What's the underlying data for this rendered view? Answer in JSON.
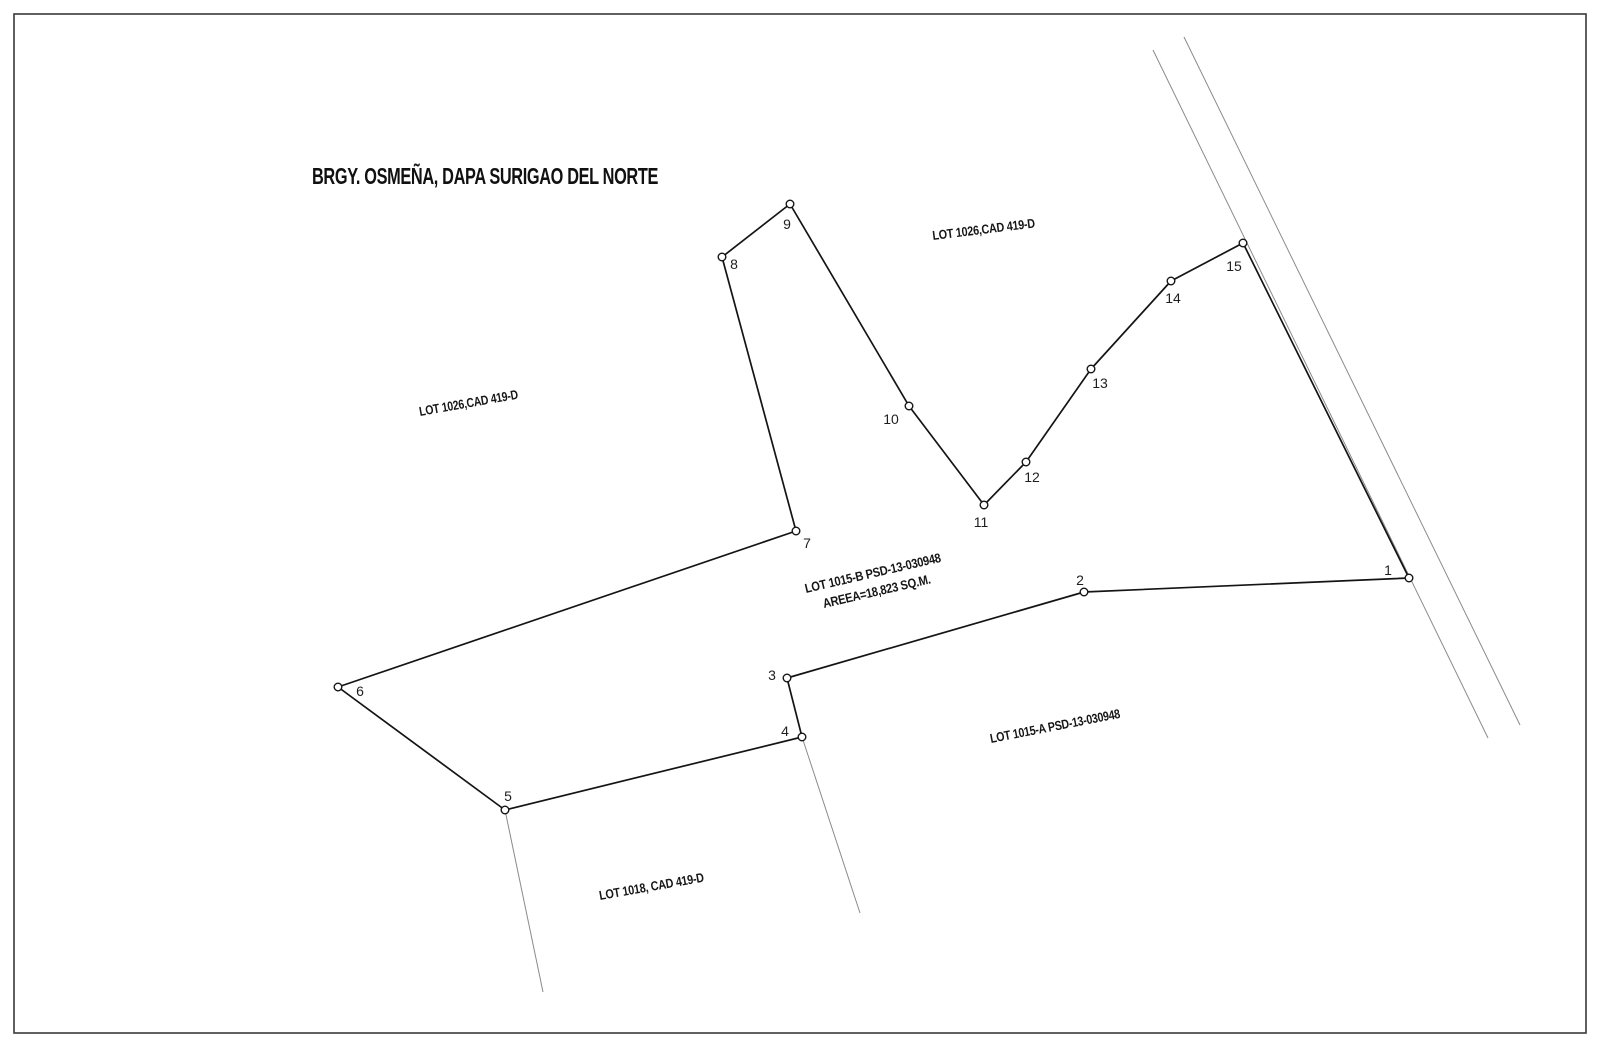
{
  "title": {
    "text": "BRGY. OSMEÑA, DAPA SURIGAO DEL NORTE"
  },
  "diagram": {
    "canvas": {
      "width": 1600,
      "height": 1047
    },
    "border": {
      "x": 14,
      "y": 14,
      "width": 1572,
      "height": 1019
    },
    "colors": {
      "background": "#ffffff",
      "boundary": "#141414",
      "thin_lines": "#8b8b8b",
      "text": "#161616"
    },
    "road_lines": [
      {
        "x1": 1153,
        "y1": 50,
        "x2": 1488,
        "y2": 738
      },
      {
        "x1": 1184,
        "y1": 37,
        "x2": 1520,
        "y2": 725
      }
    ],
    "tie_lines": [
      {
        "x1": 505,
        "y1": 810,
        "x2": 543,
        "y2": 992
      },
      {
        "x1": 802,
        "y1": 737,
        "x2": 860,
        "y2": 913
      }
    ],
    "boundary_order": [
      "1",
      "2",
      "3",
      "4",
      "5",
      "6",
      "7",
      "8",
      "9",
      "10",
      "11",
      "12",
      "13",
      "14",
      "15"
    ],
    "vertices": [
      {
        "n": "1",
        "x": 1409,
        "y": 578,
        "lx": 1388,
        "ly": 570
      },
      {
        "n": "2",
        "x": 1084,
        "y": 592,
        "lx": 1080,
        "ly": 580
      },
      {
        "n": "3",
        "x": 787,
        "y": 678,
        "lx": 772,
        "ly": 675
      },
      {
        "n": "4",
        "x": 802,
        "y": 737,
        "lx": 785,
        "ly": 731
      },
      {
        "n": "5",
        "x": 505,
        "y": 810,
        "lx": 508,
        "ly": 796
      },
      {
        "n": "6",
        "x": 338,
        "y": 687,
        "lx": 360,
        "ly": 691
      },
      {
        "n": "7",
        "x": 796,
        "y": 531,
        "lx": 807,
        "ly": 543
      },
      {
        "n": "8",
        "x": 722,
        "y": 257,
        "lx": 734,
        "ly": 264
      },
      {
        "n": "9",
        "x": 790,
        "y": 204,
        "lx": 787,
        "ly": 224
      },
      {
        "n": "10",
        "x": 909,
        "y": 406,
        "lx": 891,
        "ly": 419
      },
      {
        "n": "11",
        "x": 984,
        "y": 505,
        "lx": 981,
        "ly": 522
      },
      {
        "n": "12",
        "x": 1026,
        "y": 462,
        "lx": 1032,
        "ly": 477
      },
      {
        "n": "13",
        "x": 1091,
        "y": 369,
        "lx": 1100,
        "ly": 383
      },
      {
        "n": "14",
        "x": 1171,
        "y": 281,
        "lx": 1173,
        "ly": 298
      },
      {
        "n": "15",
        "x": 1243,
        "y": 243,
        "lx": 1234,
        "ly": 266
      }
    ],
    "lot_labels": [
      {
        "text": "LOT 1026,CAD 419-D",
        "x": 933,
        "y": 240,
        "angle": -7,
        "length": 103
      },
      {
        "text": "LOT 1026,CAD 419-D",
        "x": 420,
        "y": 416,
        "angle": -10,
        "length": 100
      },
      {
        "text": "LOT 1015-B PSD-13-030948",
        "x": 806,
        "y": 593,
        "angle": -13,
        "length": 139
      },
      {
        "text": "AREEA=18,823 SQ.M.",
        "x": 824,
        "y": 608,
        "angle": -13,
        "length": 110
      },
      {
        "text": "LOT 1015-A PSD-13-030948",
        "x": 991,
        "y": 743,
        "angle": -11,
        "length": 132
      },
      {
        "text": "LOT 1018, CAD 419-D",
        "x": 600,
        "y": 900,
        "angle": -10,
        "length": 106
      }
    ],
    "title_pos": {
      "x": 312,
      "y": 184,
      "length": 346
    }
  }
}
